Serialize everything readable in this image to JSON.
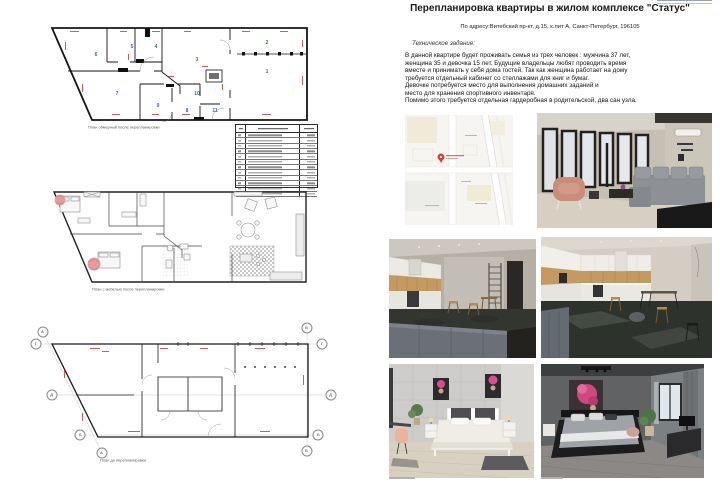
{
  "document": {
    "title": "Перепланировка квартиры в жилом комплексе \"Статус\"",
    "subtitle": "По адресу:Витебский пр-кт, д.15, к.лит А, Санкт-Петербург, 196105"
  },
  "brief": {
    "heading": "Техническое задание:",
    "lines": [
      "В данной квартире будет проживать семья из трех человек : мужчина 37 лет,",
      "женщина 35 и девочка 15 лет. Будущие владельцы любят проводить время",
      "вместе и принимать у себя дома гостей. Так как женщина работает на дому",
      "требуется отдельный кабинет со стеллажами для книг и бумаг.",
      "Девочке потребуется место для выполнения домашних заданий и",
      "место для хранения спортивного инвентаря.",
      "Помимо этого требуется отдельная гардеробная в родительской, два сан узла."
    ]
  },
  "plans": {
    "measured": {
      "caption": "План обмерный после перепланировки",
      "rooms": [
        {
          "n": "1",
          "x": 235,
          "y": 46
        },
        {
          "n": "2",
          "x": 235,
          "y": 17
        },
        {
          "n": "3",
          "x": 165,
          "y": 34
        },
        {
          "n": "4",
          "x": 124,
          "y": 21
        },
        {
          "n": "5",
          "x": 100,
          "y": 21
        },
        {
          "n": "6",
          "x": 64,
          "y": 29
        },
        {
          "n": "7",
          "x": 85,
          "y": 68
        },
        {
          "n": "8",
          "x": 155,
          "y": 85
        },
        {
          "n": "9",
          "x": 126,
          "y": 80
        },
        {
          "n": "10",
          "x": 165,
          "y": 68
        },
        {
          "n": "11",
          "x": 183,
          "y": 85
        }
      ]
    },
    "furnished": {
      "caption": "План с мебелью после перепланировки"
    },
    "before": {
      "caption": "План до перепланировки",
      "axes": [
        {
          "label": "А",
          "x": 13,
          "y": 17
        },
        {
          "label": "Г",
          "x": 6,
          "y": 29
        },
        {
          "label": "Д",
          "x": 22,
          "y": 80
        },
        {
          "label": "Б",
          "x": 50,
          "y": 120
        },
        {
          "label": "А",
          "x": 72,
          "y": 138
        },
        {
          "label": "В",
          "x": 277,
          "y": 13
        },
        {
          "label": "Г",
          "x": 292,
          "y": 29
        },
        {
          "label": "Д",
          "x": 301,
          "y": 80
        },
        {
          "label": "Б",
          "x": 288,
          "y": 120
        },
        {
          "label": "В",
          "x": 277,
          "y": 136
        }
      ]
    }
  },
  "schedule": {
    "rows": [
      "",
      "",
      "",
      "",
      "",
      "",
      "",
      "",
      "",
      "",
      "",
      ""
    ]
  },
  "photos": {
    "living_room": "living room render",
    "kitchen_dining_left": "kitchen-dining render 1",
    "kitchen_dining_right": "kitchen-dining render 2",
    "bedroom_light": "light bedroom render",
    "bedroom_dark": "dark bedroom render",
    "map": "location map"
  },
  "colors": {
    "dimension_red": "#c0392b",
    "room_number_blue": "#3f5fc4",
    "map_pin_red": "#d6453a",
    "accent_pink": "#d0487f"
  }
}
